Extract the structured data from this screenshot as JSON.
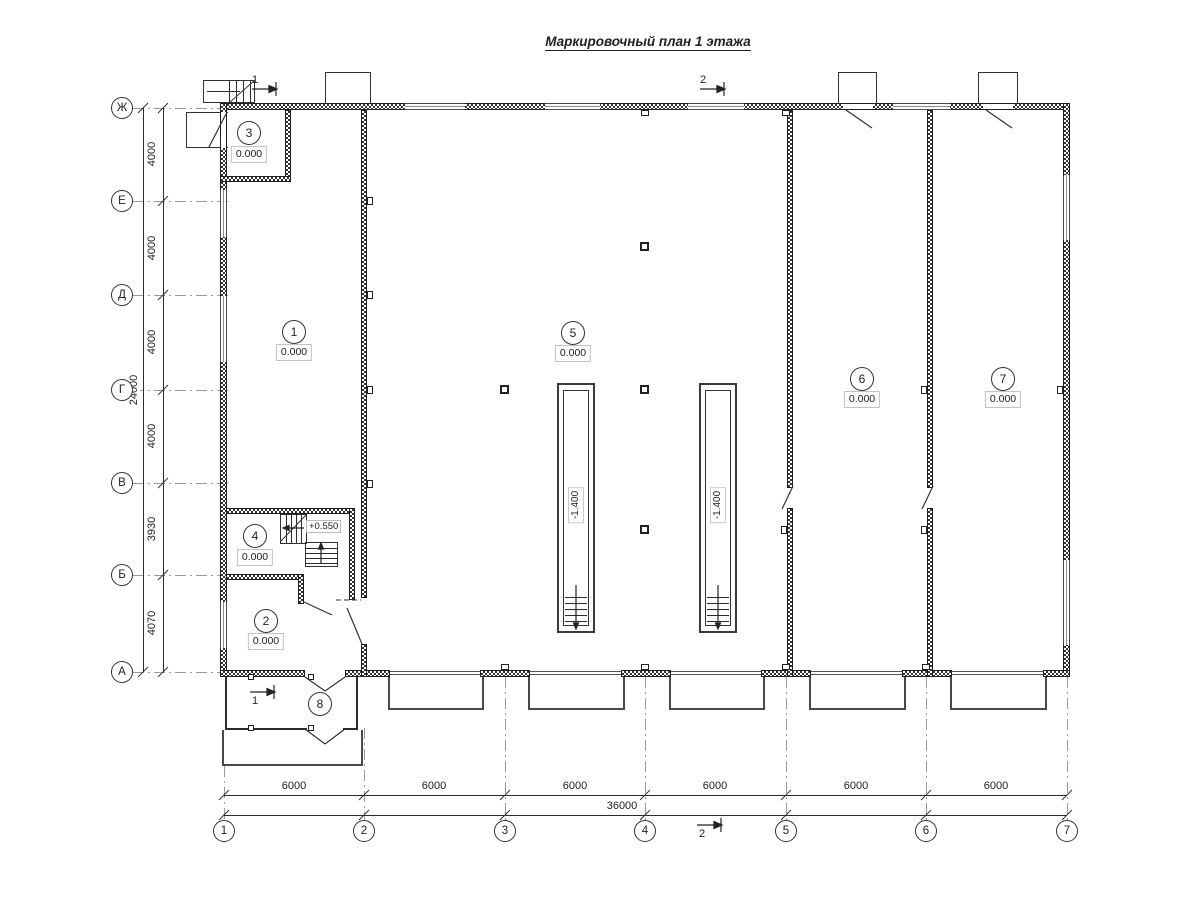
{
  "title": "Маркировочный план 1 этажа",
  "axes": {
    "letters": [
      "Ж",
      "Е",
      "Д",
      "Г",
      "В",
      "Б",
      "А"
    ],
    "numbers": [
      "1",
      "2",
      "3",
      "4",
      "5",
      "6",
      "7"
    ]
  },
  "dims": {
    "left": [
      "4000",
      "4000",
      "4000",
      "4000",
      "3930",
      "4070"
    ],
    "left_total": "24000",
    "bottom": [
      "6000",
      "6000",
      "6000",
      "6000",
      "6000",
      "6000"
    ],
    "bottom_total": "36000"
  },
  "rooms": [
    {
      "num": "1",
      "elev": "0.000"
    },
    {
      "num": "2",
      "elev": "0.000"
    },
    {
      "num": "3",
      "elev": "0.000"
    },
    {
      "num": "4",
      "elev": "0.000"
    },
    {
      "num": "5",
      "elev": "0.000"
    },
    {
      "num": "6",
      "elev": "0.000"
    },
    {
      "num": "7",
      "elev": "0.000"
    },
    {
      "num": "8"
    }
  ],
  "marks": {
    "pit_elev": "-1.400",
    "stair_elev": "+0.550"
  },
  "sections": {
    "s1": "1",
    "s2": "2"
  },
  "colors": {
    "line": "#222222",
    "grid": "#999999",
    "background": "#ffffff"
  }
}
